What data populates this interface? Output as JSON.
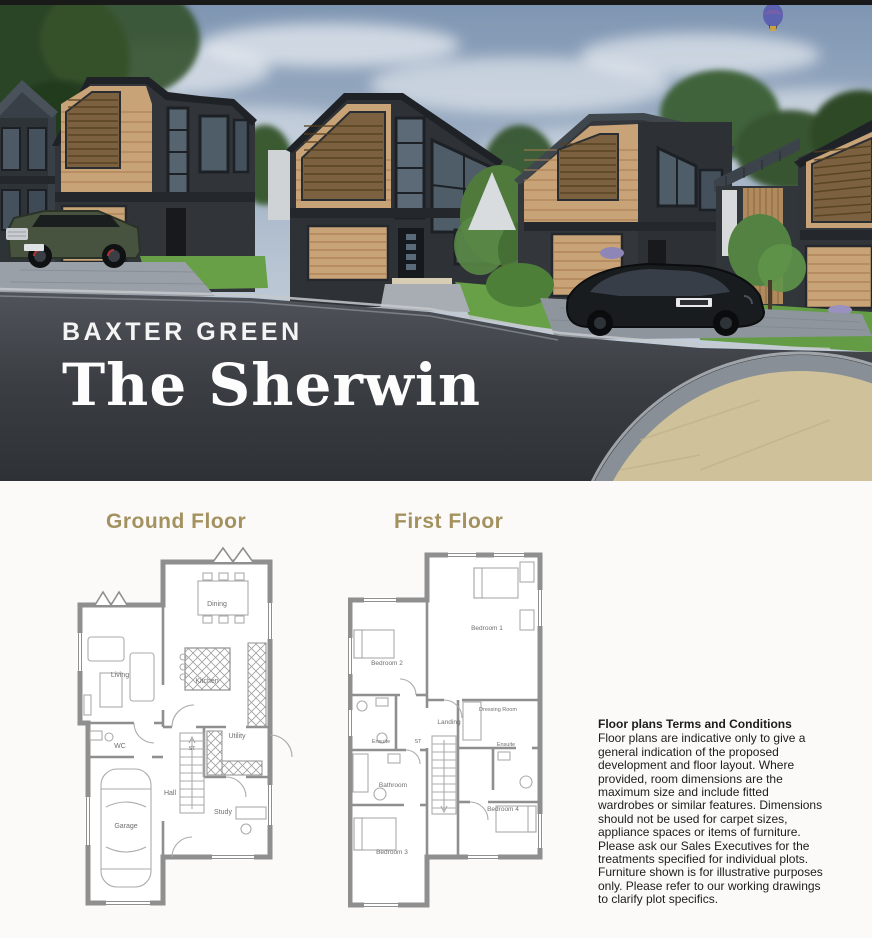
{
  "hero": {
    "development_name": "BAXTER GREEN",
    "house_name": "The Sherwin"
  },
  "plans": {
    "ground": {
      "title": "Ground Floor",
      "rooms": [
        "Dining",
        "Living",
        "Kitchen",
        "WC",
        "Utility",
        "ST",
        "Hall",
        "Study",
        "Garage"
      ]
    },
    "first": {
      "title": "First Floor",
      "rooms": [
        "Bedroom 1",
        "Bedroom 2",
        "Dressing Room",
        "Landing",
        "Ensuite",
        "ST",
        "Ensuite",
        "Bathroom",
        "Bedroom 4",
        "Bedroom 3"
      ]
    }
  },
  "terms": {
    "heading": "Floor plans Terms and Conditions",
    "lines": [
      "Floor plans are indicative only to give a",
      "general indication of the proposed",
      "development and floor layout. Where",
      "provided, room dimensions are the",
      "maximum size and include fitted",
      "wardrobes or similar features. Dimensions",
      "should not be used for carpet sizes,",
      "appliance spaces or items of furniture.",
      "Please ask our Sales Executives for the",
      "treatments specified for individual plots.",
      "Furniture shown is for illustrative purposes",
      "only. Please refer to our working drawings",
      "to clarify plot specifics."
    ]
  },
  "colors": {
    "accent_gold": "#a3925f",
    "plan_wall_grey": "#8f8f8f",
    "timber": "#c8a377",
    "dark_brick": "#32363b",
    "sky_top": "#7e95b2",
    "grass_green": "#68a04a",
    "road_asphalt": "#3a3e43",
    "paved_circle_tan": "#cfc29b"
  }
}
